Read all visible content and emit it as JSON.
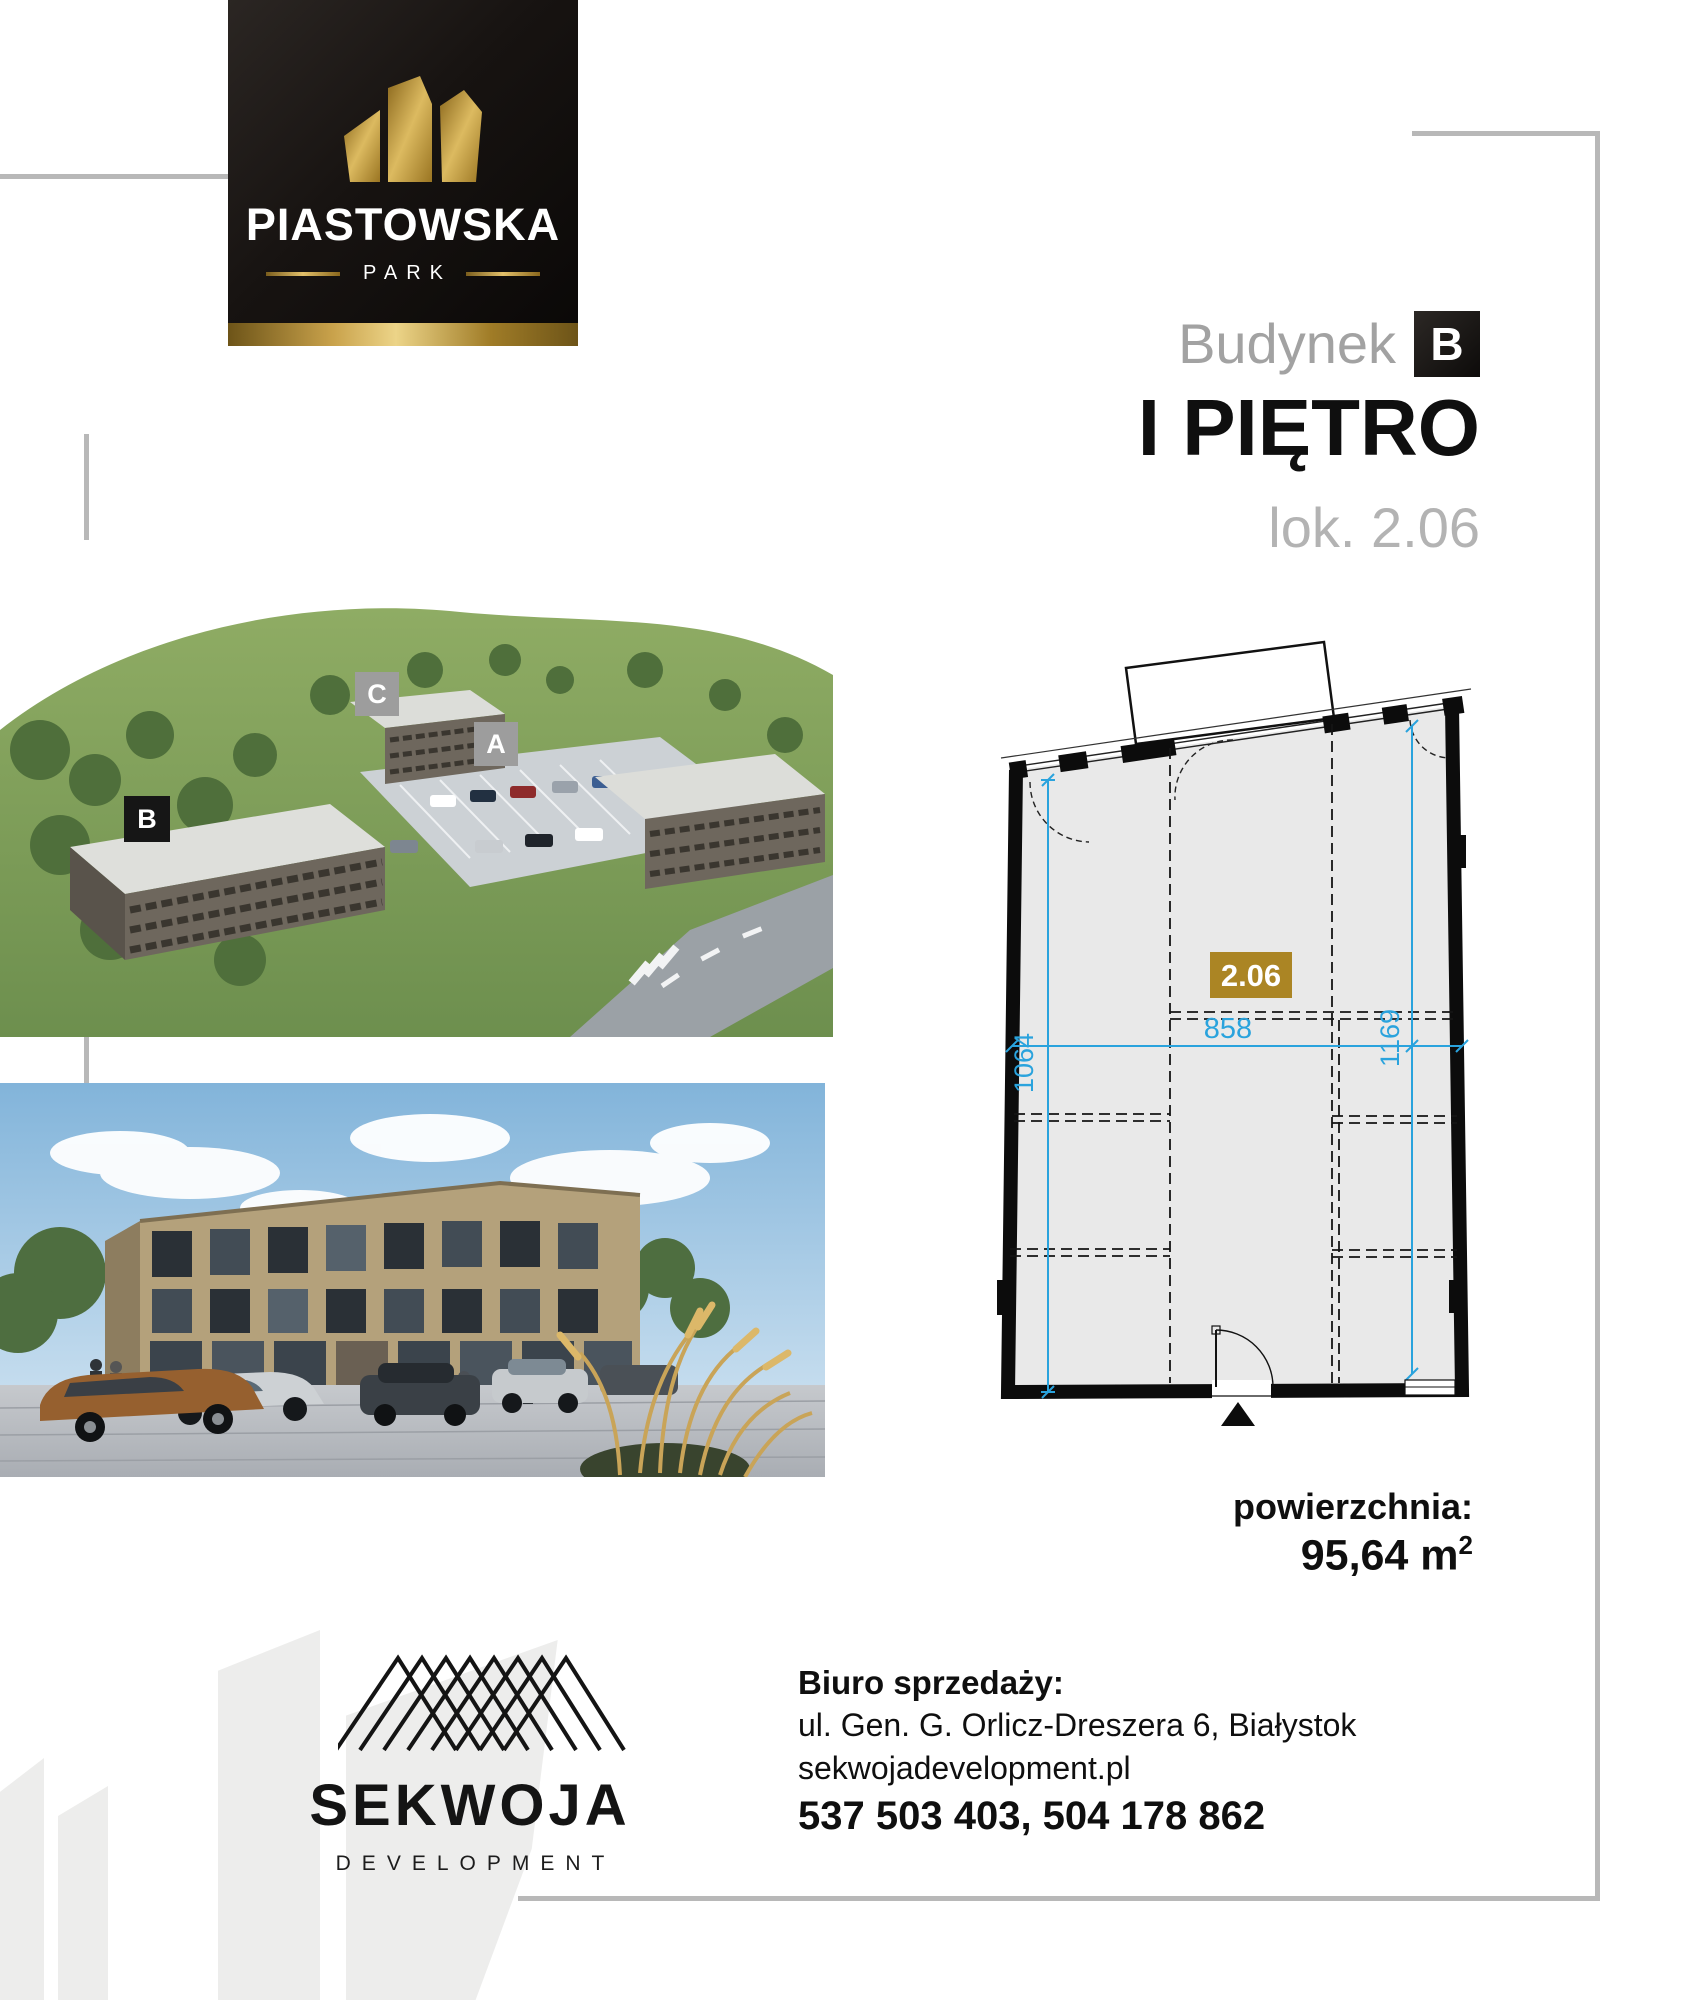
{
  "brand": {
    "title": "PIASTOWSKA",
    "subtitle": "PARK"
  },
  "header": {
    "building_label": "Budynek",
    "building_letter": "B",
    "floor": "I PIĘTRO",
    "unit": "lok. 2.06"
  },
  "site_plan": {
    "label_a": "A",
    "label_b": "B",
    "label_c": "C"
  },
  "floor_plan": {
    "unit_number": "2.06",
    "dim_width": "858",
    "dim_left": "1064",
    "dim_right": "1169"
  },
  "area": {
    "label": "powierzchnia:",
    "value": "95,64 m",
    "sup": "2"
  },
  "developer": {
    "name": "SEKWOJA",
    "subtitle": "DEVELOPMENT"
  },
  "contact": {
    "heading": "Biuro sprzedaży:",
    "address": "ul. Gen. G. Orlicz-Dreszera 6, Białystok",
    "website": "sekwojadevelopment.pl",
    "phones": "537 503 403, 504 178 862"
  },
  "icons": {
    "brand_logo": "piastowska-towers",
    "developer_logo": "sekwoja-roof-lattice",
    "entrance_marker": "triangle-up"
  },
  "colors": {
    "gold": "#c9a24b",
    "badge_gold": "#ab8524",
    "dimension_blue": "#2aa3dd",
    "gray_text": "#a2a2a2",
    "frame_gray": "#b8b8b8"
  }
}
